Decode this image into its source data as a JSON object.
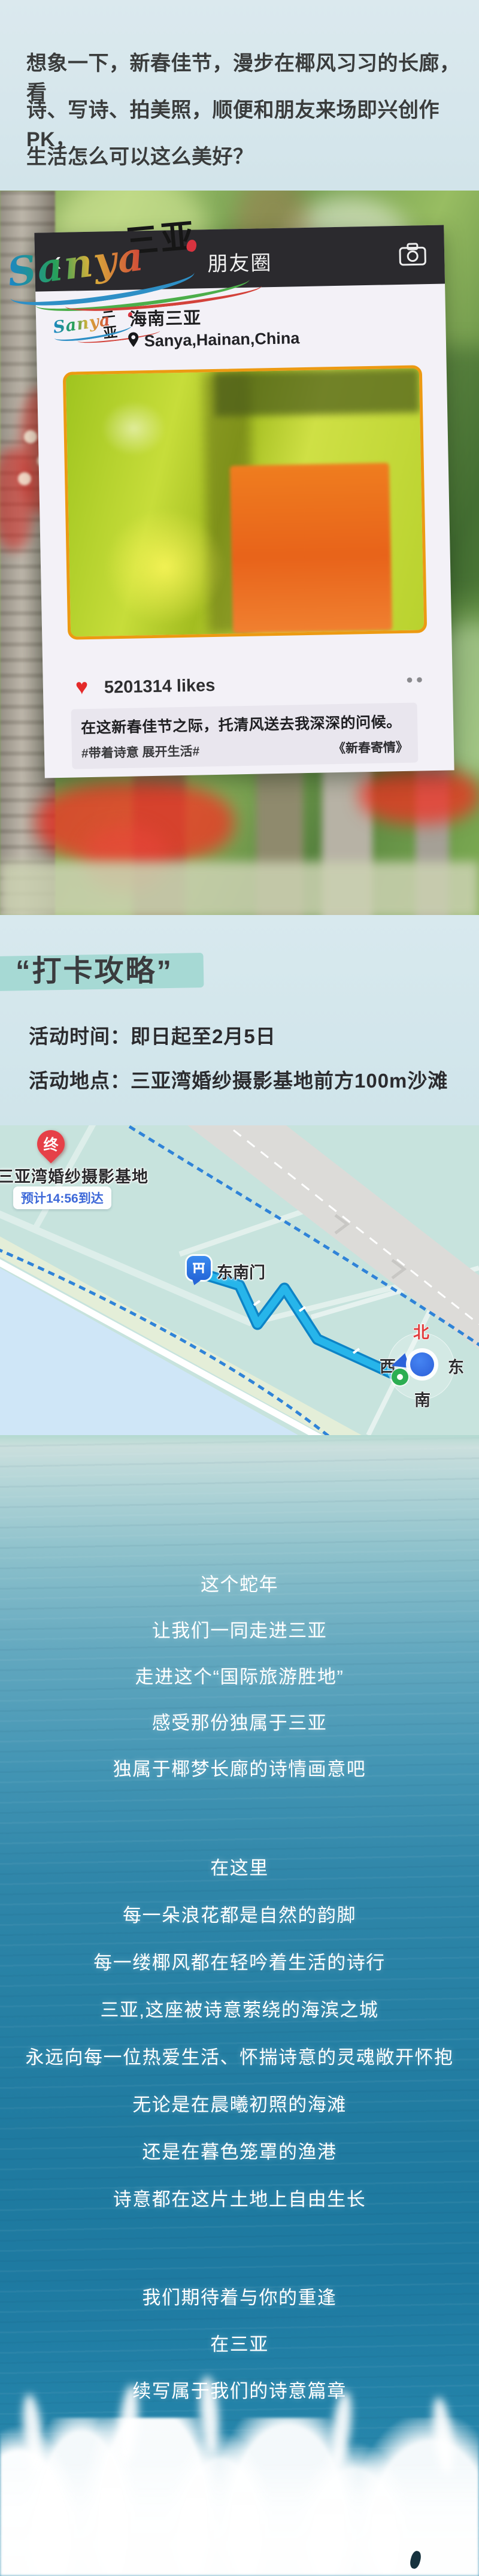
{
  "intro": {
    "lines": [
      "想象一下，新春佳节，漫步在椰风习习的长廊，看",
      "诗、写诗、拍美照，顺便和朋友来场即兴创作PK，",
      "生活怎么可以这么美好？"
    ]
  },
  "logo": {
    "script": "Sanya",
    "hanzi": "三亚"
  },
  "moments": {
    "back_icon": "‹",
    "header_title": "朋友圈",
    "profile_name": "海南三亚",
    "location": "Sanya,Hainan,China",
    "heart_icon": "♥",
    "likes": "5201314 likes",
    "more_icon": "••",
    "caption": "在这新春佳节之际，托清风送去我深深的问候。",
    "hashtag": "#带着诗意 展开生活#",
    "signature": "《新春寄情》"
  },
  "guide": {
    "title": "“打卡攻略”",
    "time": "活动时间：即日起至2月5日",
    "place": "活动地点：三亚湾婚纱摄影基地前方100m沙滩"
  },
  "map": {
    "end_pin": "终",
    "destination": "三亚湾婚纱摄影基地",
    "eta": "预计14:56到达",
    "gate": "东南门",
    "compass_n": "北",
    "compass_w": "西",
    "compass_e": "东",
    "compass_s": "南"
  },
  "poem": {
    "s1": [
      "这个蛇年",
      "让我们一同走进三亚",
      "走进这个“国际旅游胜地”",
      "感受那份独属于三亚",
      "独属于椰梦长廊的诗情画意吧"
    ],
    "s2": [
      "在这里",
      "每一朵浪花都是自然的韵脚",
      "每一缕椰风都在轻吟着生活的诗行",
      "三亚,这座被诗意萦绕的海滨之城",
      "永远向每一位热爱生活、怀揣诗意的灵魂敞开怀抱",
      "无论是在晨曦初照的海滩",
      "还是在暮色笼罩的渔港",
      "诗意都在这片土地上自由生长"
    ],
    "s3": [
      "我们期待着与你的重逢",
      "在三亚",
      "续写属于我们的诗意篇章"
    ]
  },
  "colors": {
    "highlight_teal": "#a6d9d4",
    "route_blue": "#27b5ea",
    "pin_red": "#e64048",
    "heart_red": "#e42a2a",
    "eta_blue": "#3d68d8",
    "photo_border_orange": "#ec9a12"
  }
}
